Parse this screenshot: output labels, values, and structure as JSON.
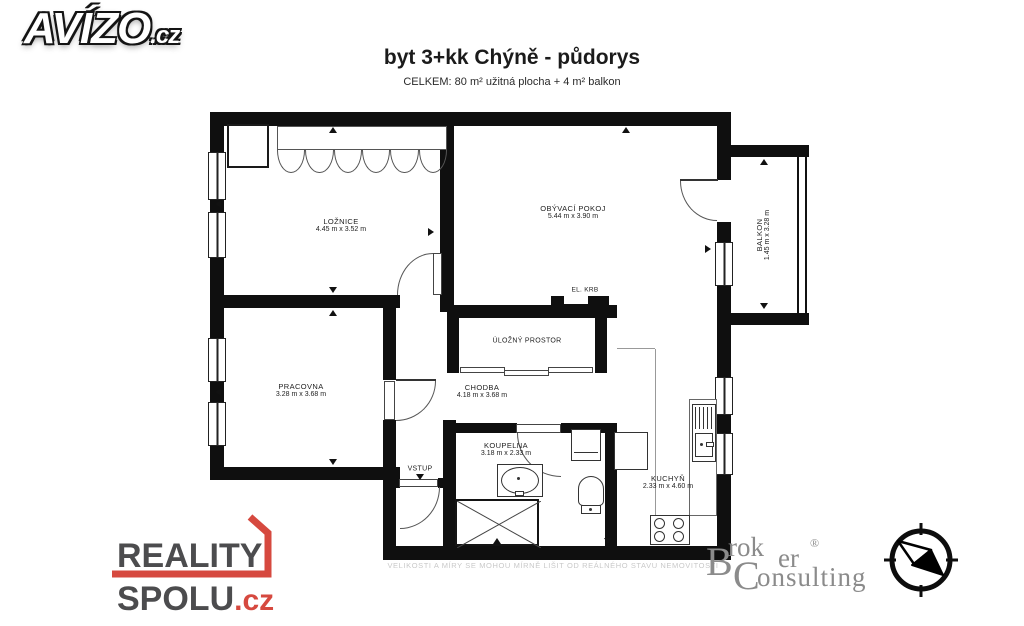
{
  "header": {
    "brand": "AVÍZO",
    "brand_tld": ".cz",
    "title": "byt 3+kk Chýně - půdorys",
    "subtitle": "CELKEM: 80 m² užitná plocha + 4 m² balkon"
  },
  "floorplan": {
    "rooms": [
      {
        "name": "LOŽNICE",
        "dims": "4.45 m x 3.52 m"
      },
      {
        "name": "OBÝVACÍ POKOJ",
        "dims": "5.44 m x 3.90 m"
      },
      {
        "name": "BALKON",
        "dims": "1.45 m x 3.28 m"
      },
      {
        "name": "PRACOVNA",
        "dims": "3.28 m x 3.68 m"
      },
      {
        "name": "CHODBA",
        "dims": "4.18 m x 3.68 m"
      },
      {
        "name": "KOUPELNA",
        "dims": "3.18 m x 2.33 m"
      },
      {
        "name": "KUCHYŇ",
        "dims": "2.33 m x 4.60 m"
      }
    ],
    "labels": {
      "storage": "ÚLOŽNÝ PROSTOR",
      "fireplace": "EL. KRB",
      "entrance": "VSTUP"
    },
    "disclaimer": "VELIKOSTI A MÍRY SE MOHOU MÍRNĚ LIŠIT OD REÁLNÉHO STAVU NEMOVITOSTI"
  },
  "footer": {
    "reality": {
      "line1": "REALITY",
      "line2": "SPOLU",
      "tld": ".cz"
    },
    "broker": {
      "b": "B",
      "rok": "rok",
      "er": "er",
      "reg": "®",
      "c": "C",
      "onsulting": "onsulting"
    }
  },
  "colors": {
    "wall": "#0f0f0f",
    "reality_red": "#d6493f",
    "broker_red": "#df675c",
    "broker_gray": "#8b8b8b"
  }
}
